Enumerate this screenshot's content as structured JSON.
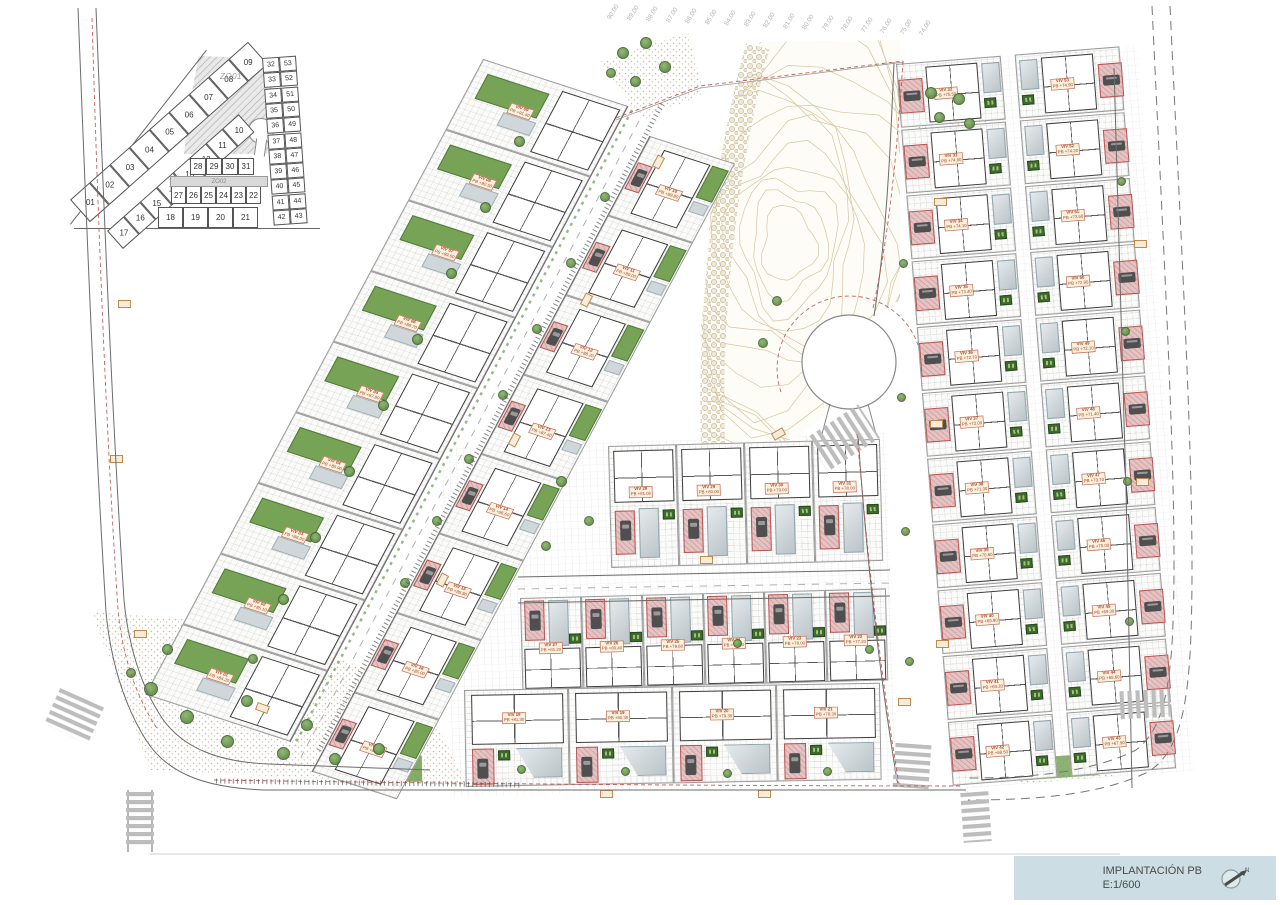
{
  "meta": {
    "title": "IMPLANTACIÓN PB",
    "scale": "E:1/600",
    "north_label": "N"
  },
  "colors": {
    "pool_green": "#76a356",
    "pool_gray": "#c6d0d5",
    "drive_pink": "#e3c3c3",
    "drive_border": "#b85450",
    "contour_tan": "#d5c6a2",
    "red_line": "#c0504d",
    "titlebox": "#ccdde3",
    "wall": "#3c3c3c"
  },
  "key_plan": {
    "zone1_label": "ZO01",
    "zone2_label": "ZO02",
    "outer_row": [
      "01",
      "02",
      "03",
      "04",
      "05",
      "06",
      "07",
      "08",
      "09"
    ],
    "inner_row": [
      "17",
      "16",
      "15",
      "14",
      "13",
      "12",
      "11",
      "10"
    ],
    "grid_rows": [
      [
        "28",
        "29",
        "30",
        "31"
      ],
      [
        "27",
        "26",
        "25",
        "24",
        "23",
        "22"
      ],
      [
        "18",
        "19",
        "20",
        "21"
      ]
    ],
    "right_pairs": [
      [
        "32",
        "53"
      ],
      [
        "33",
        "52"
      ],
      [
        "34",
        "51"
      ],
      [
        "35",
        "50"
      ],
      [
        "36",
        "49"
      ],
      [
        "37",
        "48"
      ],
      [
        "38",
        "47"
      ],
      [
        "39",
        "46"
      ],
      [
        "40",
        "45"
      ],
      [
        "41",
        "44"
      ],
      [
        "42",
        "43"
      ]
    ]
  },
  "elevation_marks": [
    "90.00",
    "89.00",
    "88.00",
    "87.00",
    "86.00",
    "85.00",
    "84.00",
    "83.00",
    "82.00",
    "81.00",
    "80.00",
    "79.00",
    "78.00",
    "77.00",
    "76.00",
    "75.00",
    "74.00"
  ],
  "sections": {
    "left_outer": [
      {
        "n": "VIV 09",
        "pb": "PB +91.40"
      },
      {
        "n": "VIV 08",
        "pb": "PB +90.50"
      },
      {
        "n": "VIV 07",
        "pb": "PB +89.60"
      },
      {
        "n": "VIV 06",
        "pb": "PB +88.70"
      },
      {
        "n": "VIV 05",
        "pb": "PB +87.80"
      },
      {
        "n": "VIV 04",
        "pb": "PB +86.90"
      },
      {
        "n": "VIV 03",
        "pb": "PB +86.00"
      },
      {
        "n": "VIV 02",
        "pb": "PB +85.10"
      },
      {
        "n": "VIV 01",
        "pb": "PB +84.20"
      }
    ],
    "left_inner": [
      {
        "n": "VIV 10",
        "pb": "PB +89.80"
      },
      {
        "n": "VIV 11",
        "pb": "PB +89.00"
      },
      {
        "n": "VIV 12",
        "pb": "PB +88.20"
      },
      {
        "n": "VIV 13",
        "pb": "PB +87.40"
      },
      {
        "n": "VIV 14",
        "pb": "PB +86.60"
      },
      {
        "n": "VIV 15",
        "pb": "PB +85.80"
      },
      {
        "n": "VIV 16",
        "pb": "PB +85.00"
      },
      {
        "n": "VIV 17",
        "pb": "PB +84.20"
      }
    ],
    "row_up": [
      {
        "n": "VIV 28",
        "pb": "PB +81.00"
      },
      {
        "n": "VIV 29",
        "pb": "PB +80.00"
      },
      {
        "n": "VIV 30",
        "pb": "PB +79.00"
      },
      {
        "n": "VIV 31",
        "pb": "PB +78.00"
      }
    ],
    "row_mid": [
      {
        "n": "VIV 27",
        "pb": "PB +81.20"
      },
      {
        "n": "VIV 26",
        "pb": "PB +80.40"
      },
      {
        "n": "VIV 25",
        "pb": "PB +79.60"
      },
      {
        "n": "VIV 24",
        "pb": "PB +78.80"
      },
      {
        "n": "VIV 23",
        "pb": "PB +78.00"
      },
      {
        "n": "VIV 22",
        "pb": "PB +77.20"
      }
    ],
    "row_bot": [
      {
        "n": "VIV 18",
        "pb": "PB +81.30"
      },
      {
        "n": "VIV 19",
        "pb": "PB +80.30"
      },
      {
        "n": "VIV 20",
        "pb": "PB +79.30"
      },
      {
        "n": "VIV 21",
        "pb": "PB +78.30"
      }
    ],
    "right_block": [
      {
        "l": {
          "n": "VIV 32",
          "pb": "PB +75.50"
        },
        "r": {
          "n": "VIV 53",
          "pb": "PB +74.90"
        }
      },
      {
        "l": {
          "n": "VIV 33",
          "pb": "PB +74.80"
        },
        "r": {
          "n": "VIV 52",
          "pb": "PB +74.20"
        }
      },
      {
        "l": {
          "n": "VIV 34",
          "pb": "PB +74.10"
        },
        "r": {
          "n": "VIV 51",
          "pb": "PB +73.50"
        }
      },
      {
        "l": {
          "n": "VIV 35",
          "pb": "PB +73.40"
        },
        "r": {
          "n": "VIV 50",
          "pb": "PB +72.80"
        }
      },
      {
        "l": {
          "n": "VIV 36",
          "pb": "PB +72.70"
        },
        "r": {
          "n": "VIV 49",
          "pb": "PB +72.10"
        }
      },
      {
        "l": {
          "n": "VIV 37",
          "pb": "PB +72.00"
        },
        "r": {
          "n": "VIV 48",
          "pb": "PB +71.40"
        }
      },
      {
        "l": {
          "n": "VIV 38",
          "pb": "PB +71.30"
        },
        "r": {
          "n": "VIV 47",
          "pb": "PB +70.70"
        }
      },
      {
        "l": {
          "n": "VIV 39",
          "pb": "PB +70.60"
        },
        "r": {
          "n": "VIV 46",
          "pb": "PB +70.00"
        }
      },
      {
        "l": {
          "n": "VIV 40",
          "pb": "PB +69.90"
        },
        "r": {
          "n": "VIV 45",
          "pb": "PB +69.30"
        }
      },
      {
        "l": {
          "n": "VIV 41",
          "pb": "PB +69.20"
        },
        "r": {
          "n": "VIV 44",
          "pb": "PB +68.60"
        }
      },
      {
        "l": {
          "n": "VIV 42",
          "pb": "PB +68.50"
        },
        "r": {
          "n": "VIV 43",
          "pb": "PB +67.90"
        }
      }
    ]
  }
}
